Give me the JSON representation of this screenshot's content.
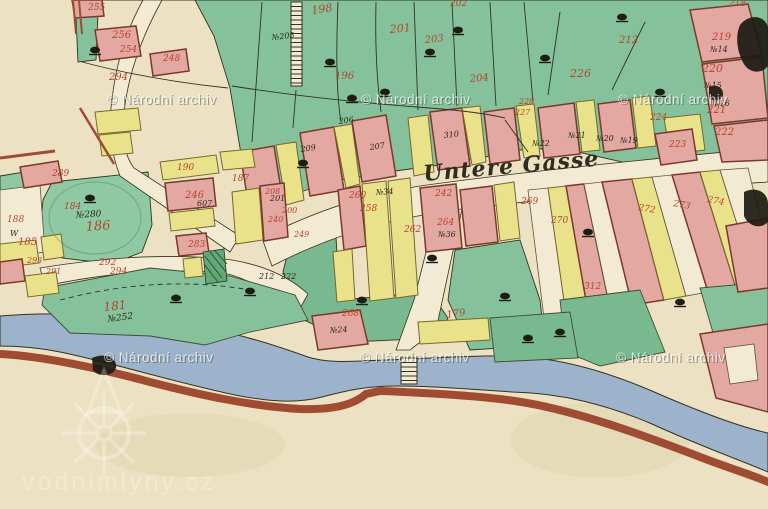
{
  "street": {
    "label": "Untere Gasse"
  },
  "watermarks": {
    "archive_text": "© Národní archiv",
    "archive_positions": [
      [
        107,
        104
      ],
      [
        361,
        104
      ],
      [
        618,
        104
      ],
      [
        104,
        362
      ],
      [
        360,
        362
      ],
      [
        616,
        362
      ]
    ],
    "logo_text": "vodnimlyny.cz"
  },
  "palette": {
    "paper": "#ece2c3",
    "road": "#f2ead3",
    "green": "#85c29b",
    "green2": "#79b98f",
    "green3": "#8fc9a3",
    "green_dark": "#5fa878",
    "yellow": "#e9e28b",
    "pink": "#e3a8a2",
    "pink2": "#dd9a94",
    "river": "#9db3cb",
    "shore": "#a04c32",
    "line": "#33321f",
    "red": "#b5452c",
    "black": "#2b2a1e",
    "wm": "rgba(255,255,255,0.72)",
    "wm_shadow": "rgba(50,50,40,0.45)",
    "wm_logo": "rgba(255,255,255,0.28)"
  },
  "fields": [
    {
      "p": "78,0 768,0 768,172 700,163 640,166 560,148 520,150 455,163 395,171 340,180 300,192 265,207 250,188 240,148 230,88 214,36 195,0",
      "f": "green"
    },
    {
      "p": "52,182 148,172 152,225 142,252 112,264 62,258 40,232 43,200",
      "f": "green3"
    },
    {
      "p": "292,235 335,222 340,300 430,292 448,318 438,338 350,342 300,318 283,272",
      "f": "green2"
    },
    {
      "p": "455,250 520,240 540,300 545,345 470,350 448,300",
      "f": "green"
    },
    {
      "p": "76,18 98,14 96,60 78,62",
      "f": "green"
    },
    {
      "p": "0,176 30,171 33,196 0,200",
      "f": "green3"
    }
  ],
  "roads": [
    {
      "d": "M143,0 L162,0 Q130,58 124,112 Q120,150 134,168 L240,236 L230,252 L120,176 Q106,140 112,100 Q118,45 143,0 Z"
    },
    {
      "d": "M262,238 Q340,198 420,186 Q550,168 768,148 L768,182 Q550,196 430,214 Q350,226 272,266 Z"
    },
    {
      "d": "M436,212 L462,209 L436,330 L410,350 L396,350 L414,300 Z"
    },
    {
      "d": "M40,268 Q150,250 232,260 Q280,268 308,294 L298,312 Q258,282 228,274 Q150,264 45,286 Z"
    }
  ],
  "river": {
    "d": "M0,316 C60,311 130,315 200,327 C245,335 280,347 308,357 C330,364 355,361 385,360 C420,359 470,355 512,356 C560,358 605,371 652,391 C700,412 740,427 768,433 L768,472 C740,460 700,446 652,424 C605,404 560,393 512,392 C470,389 430,386 395,386 C365,386 345,391 322,397 C295,404 268,401 240,396 C180,384 110,362 60,352 C35,347 12,346 0,346 Z",
    "shore_d": "M0,354 C40,356 90,366 150,382 C200,395 250,406 300,409 C330,410 352,406 366,394 L380,391 C430,393 480,396 515,401 C570,409 635,432 695,455 C725,467 750,474 768,482"
  },
  "buildings": [
    {
      "p": "45,288 150,268 230,276 295,295 308,320 250,332 205,345 150,336 70,333 42,305",
      "f": "green"
    },
    {
      "p": "528,190 548,188 566,315 544,318",
      "f": "road"
    },
    {
      "p": "548,188 566,186 588,312 566,315",
      "f": "yellow"
    },
    {
      "p": "566,186 584,184 610,308 588,312",
      "f": "pink"
    },
    {
      "p": "584,184 602,182 632,305 610,308",
      "f": "road"
    },
    {
      "p": "602,182 632,179 664,300 632,305",
      "f": "pink"
    },
    {
      "p": "632,179 652,177 686,296 664,300",
      "f": "yellow"
    },
    {
      "p": "652,177 672,175 708,292 686,296",
      "f": "road"
    },
    {
      "p": "672,175 700,172 736,288 708,292",
      "f": "pink"
    },
    {
      "p": "700,172 720,170 756,284 736,288",
      "f": "yellow"
    },
    {
      "p": "720,170 748,168 768,250 768,282 756,284",
      "f": "road"
    },
    {
      "p": "560,300 640,290 665,352 600,366 566,352",
      "f": "green2"
    },
    {
      "p": "700,288 768,282 768,360 718,350",
      "f": "green"
    },
    {
      "p": "490,318 570,312 578,358 495,362",
      "f": "green2"
    },
    {
      "p": "726,226 768,218 768,288 738,292",
      "f": "pink"
    },
    {
      "p": "700,334 768,324 768,412 716,398",
      "f": "pink"
    },
    {
      "p": "724,348 754,344 758,380 730,384",
      "f": "road"
    },
    {
      "p": "240,152 274,146 284,208 250,214",
      "f": "pink"
    },
    {
      "p": "276,145 296,142 304,200 286,205",
      "f": "yellow"
    },
    {
      "p": "300,133 334,127 344,190 310,196",
      "f": "pink"
    },
    {
      "p": "334,127 352,124 360,184 346,188",
      "f": "yellow"
    },
    {
      "p": "352,121 386,115 396,176 362,182",
      "f": "pink"
    },
    {
      "p": "408,118 428,115 434,172 414,176",
      "f": "yellow"
    },
    {
      "p": "430,112 462,108 470,166 438,170",
      "f": "pink"
    },
    {
      "p": "462,108 480,106 486,162 472,165",
      "f": "yellow"
    },
    {
      "p": "484,112 514,108 520,160 490,164",
      "f": "pink"
    },
    {
      "p": "516,106 534,104 540,156 524,158",
      "f": "yellow"
    },
    {
      "p": "538,108 574,103 580,154 544,158",
      "f": "pink"
    },
    {
      "p": "576,102 594,100 600,150 582,152",
      "f": "yellow"
    },
    {
      "p": "598,104 630,100 636,148 604,152",
      "f": "pink"
    },
    {
      "p": "632,98 650,96 656,146 638,148",
      "f": "yellow"
    },
    {
      "p": "72,0 102,0 104,16 75,18",
      "f": "pink"
    },
    {
      "p": "95,30 136,26 141,56 100,61",
      "f": "pink"
    },
    {
      "p": "150,54 186,49 189,71 153,76",
      "f": "pink"
    },
    {
      "p": "95,112 138,108 141,130 98,134",
      "f": "yellow"
    },
    {
      "p": "99,135 130,132 133,153 102,156",
      "f": "yellow"
    },
    {
      "p": "690,10 748,4 762,55 702,62",
      "f": "pink"
    },
    {
      "p": "702,64 762,57 768,118 712,124",
      "f": "pink"
    },
    {
      "p": "714,126 768,120 768,160 722,162",
      "f": "pink"
    },
    {
      "p": "664,118 700,114 705,150 670,154",
      "f": "yellow"
    },
    {
      "p": "655,134 692,129 697,160 661,165",
      "f": "pink"
    },
    {
      "p": "160,162 216,155 219,173 163,180",
      "f": "yellow"
    },
    {
      "p": "220,152 252,149 255,167 223,170",
      "f": "yellow"
    },
    {
      "p": "165,183 213,178 216,206 168,211",
      "f": "pink"
    },
    {
      "p": "169,213 213,208 215,226 171,231",
      "f": "yellow"
    },
    {
      "p": "176,236 206,233 209,253 179,256",
      "f": "pink"
    },
    {
      "p": "183,259 201,257 203,276 185,278",
      "f": "yellow"
    },
    {
      "p": "232,192 259,188 263,240 236,244",
      "f": "yellow"
    },
    {
      "p": "260,186 284,183 288,237 264,241",
      "f": "pink"
    },
    {
      "p": "0,190 40,185 45,252 0,258",
      "f": "road"
    },
    {
      "p": "0,244 36,240 39,263 0,268",
      "f": "yellow"
    },
    {
      "p": "41,237 61,234 64,257 44,260",
      "f": "yellow"
    },
    {
      "p": "0,262 22,259 25,281 0,284",
      "f": "pink"
    },
    {
      "p": "25,276 56,272 59,293 28,297",
      "f": "yellow"
    },
    {
      "p": "20,167 58,161 62,182 24,188",
      "f": "pink"
    },
    {
      "p": "338,190 360,186 366,246 344,250",
      "f": "pink"
    },
    {
      "p": "362,184 386,181 394,298 370,301",
      "f": "yellow"
    },
    {
      "p": "388,181 410,178 418,295 396,298",
      "f": "yellow"
    },
    {
      "p": "420,188 456,184 462,248 426,252",
      "f": "pink"
    },
    {
      "p": "333,252 352,249 355,300 337,302",
      "f": "yellow"
    },
    {
      "p": "460,190 492,186 498,242 466,246",
      "f": "pink"
    },
    {
      "p": "494,185 514,182 520,238 500,241",
      "f": "yellow"
    },
    {
      "p": "312,316 360,310 368,344 318,350",
      "f": "pink"
    },
    {
      "p": "418,322 488,318 490,340 420,344",
      "f": "yellow"
    }
  ],
  "blots": [
    {
      "d": "M740,25 C750,12 768,16 768,30 L768,66 C760,76 746,72 742,60 C736,48 736,34 740,25 Z"
    },
    {
      "d": "M744,192 C756,186 768,192 768,204 L768,222 C760,230 748,226 744,216 Z"
    },
    {
      "d": "M709,87 C716,83 724,88 723,95 C722,101 712,102 709,97 Z"
    },
    {
      "d": "M92,358 C104,352 118,358 116,368 C114,376 98,378 93,370 Z"
    }
  ],
  "hatches": {
    "ladders": [
      {
        "x": 291,
        "y": 2,
        "w": 11,
        "h": 84,
        "step": 4.5
      },
      {
        "x": 401,
        "y": 358,
        "w": 16,
        "h": 26,
        "step": 4.5
      }
    ],
    "cross": {
      "p": "203,252 224,249 227,281 206,284",
      "segs": [
        [
          205,
          256,
          222,
          278
        ],
        [
          210,
          252,
          226,
          272
        ],
        [
          204,
          264,
          218,
          282
        ],
        [
          215,
          251,
          227,
          264
        ]
      ]
    }
  },
  "lines": [
    {
      "d": "M262,2 L252,142"
    },
    {
      "d": "M296,90 L293,128"
    },
    {
      "d": "M338,2 C336,50 336,92 341,122"
    },
    {
      "d": "M376,2 C375,42 377,82 381,112"
    },
    {
      "d": "M414,2 L418,110"
    },
    {
      "d": "M452,2 L457,106"
    },
    {
      "d": "M490,2 L496,106"
    },
    {
      "d": "M524,2 L533,102"
    },
    {
      "d": "M232,86 Q320,100 430,108 Q480,112 505,118"
    },
    {
      "d": "M82,62 Q150,80 228,88"
    },
    {
      "d": "M560,12 L548,95"
    },
    {
      "d": "M645,22 L612,90"
    },
    {
      "d": "M505,120 L528,152"
    },
    {
      "d": "M60,300 Q160,274 250,290",
      "dash": "5 4"
    },
    {
      "d": "M73,0 L76,34",
      "c": "shore",
      "w": 2
    },
    {
      "d": "M79,0 L82,34",
      "c": "shore",
      "w": 2
    },
    {
      "d": "M80,108 L114,164",
      "c": "shore",
      "w": 2.5
    },
    {
      "d": "M0,158 L55,151",
      "c": "shore",
      "w": 3
    }
  ],
  "rings": [
    {
      "cx": 95,
      "cy": 218,
      "rx": 46,
      "ry": 36
    }
  ],
  "stains": [
    {
      "cx": 600,
      "cy": 440,
      "rx": 90,
      "ry": 38
    },
    {
      "cx": 190,
      "cy": 445,
      "rx": 95,
      "ry": 32
    },
    {
      "cx": 700,
      "cy": 60,
      "rx": 60,
      "ry": 50
    }
  ],
  "trees": [
    [
      95,
      50
    ],
    [
      330,
      62
    ],
    [
      430,
      52
    ],
    [
      545,
      58
    ],
    [
      622,
      17
    ],
    [
      660,
      92
    ],
    [
      352,
      98
    ],
    [
      303,
      163
    ],
    [
      90,
      198
    ],
    [
      362,
      300
    ],
    [
      505,
      296
    ],
    [
      560,
      332
    ],
    [
      432,
      258
    ],
    [
      250,
      291
    ],
    [
      588,
      232
    ],
    [
      680,
      302
    ],
    [
      176,
      298
    ],
    [
      528,
      338
    ],
    [
      458,
      30
    ],
    [
      385,
      92
    ]
  ],
  "labels": [
    {
      "t": "255",
      "x": 88,
      "y": 10,
      "c": "r",
      "s": 9
    },
    {
      "t": "256",
      "x": 112,
      "y": 38,
      "c": "r",
      "s": 10
    },
    {
      "t": "254",
      "x": 120,
      "y": 52,
      "c": "r",
      "s": 9
    },
    {
      "t": "248",
      "x": 163,
      "y": 61,
      "c": "r",
      "s": 9
    },
    {
      "t": "294",
      "x": 109,
      "y": 80,
      "c": "r",
      "s": 10
    },
    {
      "t": "289",
      "x": 52,
      "y": 176,
      "c": "r",
      "s": 9
    },
    {
      "t": "198",
      "x": 312,
      "y": 14,
      "c": "r",
      "s": 11,
      "r": -8
    },
    {
      "t": "196",
      "x": 335,
      "y": 79,
      "c": "r",
      "s": 10
    },
    {
      "t": "201",
      "x": 390,
      "y": 33,
      "c": "r",
      "s": 11,
      "r": -5
    },
    {
      "t": "203",
      "x": 425,
      "y": 43,
      "c": "r",
      "s": 10,
      "r": -5
    },
    {
      "t": "204",
      "x": 470,
      "y": 82,
      "c": "r",
      "s": 10,
      "r": -5
    },
    {
      "t": "202",
      "x": 450,
      "y": 6,
      "c": "r",
      "s": 9
    },
    {
      "t": "212",
      "x": 619,
      "y": 43,
      "c": "r",
      "s": 10
    },
    {
      "t": "226",
      "x": 570,
      "y": 77,
      "c": "r",
      "s": 11
    },
    {
      "t": "219",
      "x": 712,
      "y": 40,
      "c": "r",
      "s": 10
    },
    {
      "t": "220",
      "x": 702,
      "y": 72,
      "c": "r",
      "s": 11
    },
    {
      "t": "221",
      "x": 707,
      "y": 113,
      "c": "r",
      "s": 10
    },
    {
      "t": "222",
      "x": 715,
      "y": 135,
      "c": "r",
      "s": 10
    },
    {
      "t": "223",
      "x": 669,
      "y": 147,
      "c": "r",
      "s": 9
    },
    {
      "t": "224",
      "x": 650,
      "y": 120,
      "c": "r",
      "s": 9
    },
    {
      "t": "228",
      "x": 519,
      "y": 104,
      "c": "r",
      "s": 8
    },
    {
      "t": "227",
      "x": 515,
      "y": 115,
      "c": "r",
      "s": 8
    },
    {
      "t": "218",
      "x": 729,
      "y": 6,
      "c": "r",
      "s": 9
    },
    {
      "t": "190",
      "x": 177,
      "y": 170,
      "c": "r",
      "s": 9
    },
    {
      "t": "187",
      "x": 232,
      "y": 181,
      "c": "r",
      "s": 9
    },
    {
      "t": "246",
      "x": 185,
      "y": 198,
      "c": "r",
      "s": 10
    },
    {
      "t": "184",
      "x": 64,
      "y": 209,
      "c": "r",
      "s": 9
    },
    {
      "t": "188",
      "x": 7,
      "y": 222,
      "c": "r",
      "s": 9
    },
    {
      "t": "185",
      "x": 18,
      "y": 245,
      "c": "r",
      "s": 10
    },
    {
      "t": "186",
      "x": 86,
      "y": 231,
      "c": "r",
      "s": 13,
      "r": -4
    },
    {
      "t": "293",
      "x": 27,
      "y": 263,
      "c": "r",
      "s": 8
    },
    {
      "t": "292",
      "x": 99,
      "y": 265,
      "c": "r",
      "s": 9
    },
    {
      "t": "294",
      "x": 110,
      "y": 274,
      "c": "r",
      "s": 9
    },
    {
      "t": "291",
      "x": 46,
      "y": 274,
      "c": "r",
      "s": 8
    },
    {
      "t": "283",
      "x": 188,
      "y": 247,
      "c": "r",
      "s": 9
    },
    {
      "t": "181",
      "x": 104,
      "y": 311,
      "c": "r",
      "s": 12,
      "r": -6
    },
    {
      "t": "179",
      "x": 447,
      "y": 318,
      "c": "r",
      "s": 10,
      "r": -8
    },
    {
      "t": "268",
      "x": 342,
      "y": 316,
      "c": "r",
      "s": 9
    },
    {
      "t": "312",
      "x": 584,
      "y": 289,
      "c": "r",
      "s": 9
    },
    {
      "t": "208",
      "x": 265,
      "y": 194,
      "c": "r",
      "s": 8
    },
    {
      "t": "200",
      "x": 282,
      "y": 213,
      "c": "r",
      "s": 8
    },
    {
      "t": "240",
      "x": 268,
      "y": 222,
      "c": "r",
      "s": 8
    },
    {
      "t": "249",
      "x": 294,
      "y": 237,
      "c": "r",
      "s": 8
    },
    {
      "t": "260",
      "x": 349,
      "y": 198,
      "c": "r",
      "s": 9
    },
    {
      "t": "258",
      "x": 360,
      "y": 211,
      "c": "r",
      "s": 9
    },
    {
      "t": "262",
      "x": 404,
      "y": 232,
      "c": "r",
      "s": 9
    },
    {
      "t": "264",
      "x": 437,
      "y": 225,
      "c": "r",
      "s": 9
    },
    {
      "t": "242",
      "x": 435,
      "y": 196,
      "c": "r",
      "s": 9
    },
    {
      "t": "269",
      "x": 521,
      "y": 204,
      "c": "r",
      "s": 9
    },
    {
      "t": "270",
      "x": 551,
      "y": 223,
      "c": "r",
      "s": 9
    },
    {
      "t": "272",
      "x": 638,
      "y": 210,
      "c": "r",
      "s": 9,
      "r": 10
    },
    {
      "t": "273",
      "x": 673,
      "y": 206,
      "c": "r",
      "s": 9,
      "r": 10
    },
    {
      "t": "274",
      "x": 707,
      "y": 202,
      "c": "r",
      "s": 9,
      "r": 10
    },
    {
      "t": "№205",
      "x": 272,
      "y": 40,
      "c": "k",
      "s": 8,
      "r": -6
    },
    {
      "t": "№280",
      "x": 76,
      "y": 218,
      "c": "k",
      "s": 9,
      "r": -4
    },
    {
      "t": "№252",
      "x": 108,
      "y": 322,
      "c": "k",
      "s": 9,
      "r": -8
    },
    {
      "t": "№14",
      "x": 710,
      "y": 52,
      "c": "k",
      "s": 8
    },
    {
      "t": "№15",
      "x": 704,
      "y": 88,
      "c": "k",
      "s": 8
    },
    {
      "t": "№16",
      "x": 712,
      "y": 106,
      "c": "k",
      "s": 8
    },
    {
      "t": "№19",
      "x": 620,
      "y": 143,
      "c": "k",
      "s": 8
    },
    {
      "t": "№20",
      "x": 596,
      "y": 141,
      "c": "k",
      "s": 8
    },
    {
      "t": "№21",
      "x": 568,
      "y": 138,
      "c": "k",
      "s": 8
    },
    {
      "t": "№22",
      "x": 532,
      "y": 146,
      "c": "k",
      "s": 8
    },
    {
      "t": "206",
      "x": 339,
      "y": 124,
      "c": "k",
      "s": 8,
      "r": -8
    },
    {
      "t": "207",
      "x": 370,
      "y": 150,
      "c": "k",
      "s": 8,
      "r": -8
    },
    {
      "t": "209",
      "x": 301,
      "y": 152,
      "c": "k",
      "s": 8,
      "r": -8
    },
    {
      "t": "310",
      "x": 444,
      "y": 138,
      "c": "k",
      "s": 8,
      "r": -6
    },
    {
      "t": "201",
      "x": 270,
      "y": 201,
      "c": "k",
      "s": 8
    },
    {
      "t": "212",
      "x": 259,
      "y": 279,
      "c": "k",
      "s": 8
    },
    {
      "t": "222",
      "x": 281,
      "y": 279,
      "c": "k",
      "s": 8
    },
    {
      "t": "607",
      "x": 197,
      "y": 206,
      "c": "k",
      "s": 8
    },
    {
      "t": "№36",
      "x": 438,
      "y": 237,
      "c": "k",
      "s": 8
    },
    {
      "t": "№34",
      "x": 376,
      "y": 195,
      "c": "k",
      "s": 8,
      "r": -4
    },
    {
      "t": "№24",
      "x": 330,
      "y": 333,
      "c": "k",
      "s": 8,
      "r": -4
    },
    {
      "t": "W",
      "x": 10,
      "y": 236,
      "c": "k",
      "s": 8
    }
  ]
}
